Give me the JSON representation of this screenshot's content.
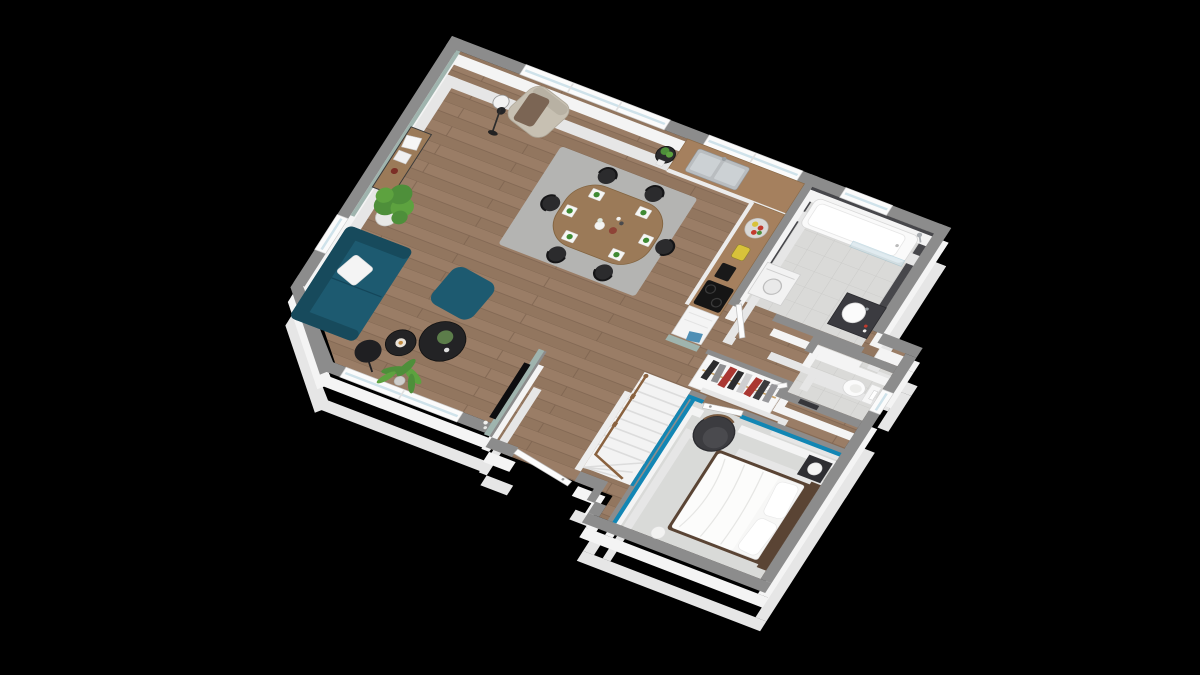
{
  "meta": {
    "kind": "3d-isometric-floor-plan-render",
    "background": "#000000",
    "visible_text": "none"
  },
  "colors": {
    "wallTop": "#8c8c8c",
    "wallSide": "#f4f4f4",
    "wallSideDeep": "#e6e6e6",
    "floorWood": "#9a7d66",
    "floorWoodAlt": "#92765f",
    "plankLine": "#7e6450",
    "tile": "#dadad8",
    "tileLine": "#c9c9c7",
    "darkTile": "#47474b",
    "carpet": "#d9dad8",
    "teal": "#1286b4",
    "sage": "#9fb4ae",
    "sofa": "#1d5a70",
    "sofaDark": "#174a5c",
    "woodFurniture": "#9b7a58",
    "woodDark": "#5a4434",
    "rug": "#b4b4b2",
    "chairBlack": "#2b2b2d",
    "white": "#f7f7f6",
    "glass": "#cfe2ea",
    "metal": "#b9bdc0",
    "plantGreen": "#4e8f3a",
    "plantGreenLight": "#5da23f",
    "lampBlack": "#242426",
    "railWood": "#8a623f",
    "hangerTan": "#caa46a",
    "towelBlue": "#4f8fb5",
    "accentRed": "#aa3732",
    "accentYellow": "#d8c23a"
  },
  "scene": {
    "rooms": [
      {
        "name": "living-dining-room",
        "floor": "wood",
        "objects": [
          "teal sofa with white pillow",
          "teal ottoman",
          "two round black nesting coffee tables",
          "black dome floor lamp",
          "beige armchair with brown throw",
          "black tripod floor lamp",
          "wood console table with frames and vase",
          "large potted plant",
          "palm plant",
          "gray rug",
          "oval wood dining table",
          "six black chairs",
          "six place settings with green napkins",
          "vase candles and bowl centerpiece",
          "black round plant stand",
          "sage green TV partition wall with flat TV"
        ]
      },
      {
        "name": "kitchen",
        "floor": "wood",
        "objects": [
          "L-shaped counter with wood top",
          "double stainless sink with faucet",
          "fruit bowl",
          "yellow blender",
          "black canister",
          "black cooktop",
          "white appliance with blue towel",
          "sage half wall"
        ]
      },
      {
        "name": "bathroom",
        "floor": "light-gray-tile",
        "objects": [
          "white bathtub with glass screen",
          "shower fixture",
          "window above tub",
          "dark tiled walls",
          "dark vanity with round white basin",
          "washing machine"
        ]
      },
      {
        "name": "wc",
        "floor": "light-gray-tile",
        "objects": [
          "wall-hung toilet",
          "flush plate",
          "window",
          "door to hall"
        ]
      },
      {
        "name": "hall-stairs",
        "floor": "wood",
        "objects": [
          "white winder staircase with wood railing",
          "open wardrobe with hanging clothes",
          "entry door in recessed alcove",
          "bathroom door",
          "wc door"
        ]
      },
      {
        "name": "bedroom",
        "floor": "light-gray-carpet",
        "objects": [
          "teal accent walls",
          "double bed with dark wood frame and white bedding",
          "two white pillows",
          "dark nightstand with white sphere lamp",
          "dark round armchair",
          "white sphere floor lamp",
          "white door to hall"
        ]
      }
    ]
  }
}
